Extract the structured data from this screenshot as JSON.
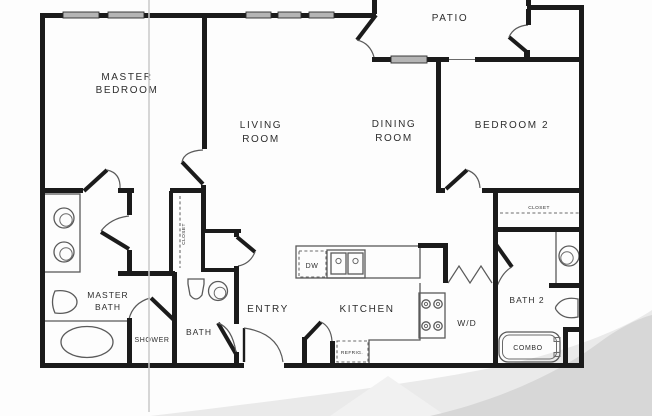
{
  "rooms": {
    "master_bedroom": {
      "line1": "MASTER",
      "line2": "BEDROOM"
    },
    "living_room": {
      "line1": "LIVING",
      "line2": "ROOM"
    },
    "dining_room": {
      "line1": "DINING",
      "line2": "ROOM"
    },
    "bedroom_2": {
      "label": "BEDROOM 2"
    },
    "patio": {
      "label": "PATIO"
    },
    "master_bath": {
      "line1": "MASTER",
      "line2": "BATH"
    },
    "shower": {
      "label": "SHOWER"
    },
    "bath": {
      "label": "BATH"
    },
    "entry": {
      "label": "ENTRY"
    },
    "kitchen": {
      "label": "KITCHEN"
    },
    "laundry": {
      "label": "W/D"
    },
    "bath_2": {
      "label": "BATH 2"
    }
  },
  "fixtures": {
    "dishwasher": "DW",
    "refrigerator": "REFRIG.",
    "tub_shower_combo": "COMBO",
    "master_closet": "CLOSET",
    "bedroom_2_closet": "CLOSET"
  },
  "colors": {
    "wall": "#1b1b1b",
    "window_fill": "#b5b5b5",
    "fold_line": "#c9c9c9",
    "watermark_dark": "#d7d7d7",
    "watermark_light": "#eaeaea"
  }
}
